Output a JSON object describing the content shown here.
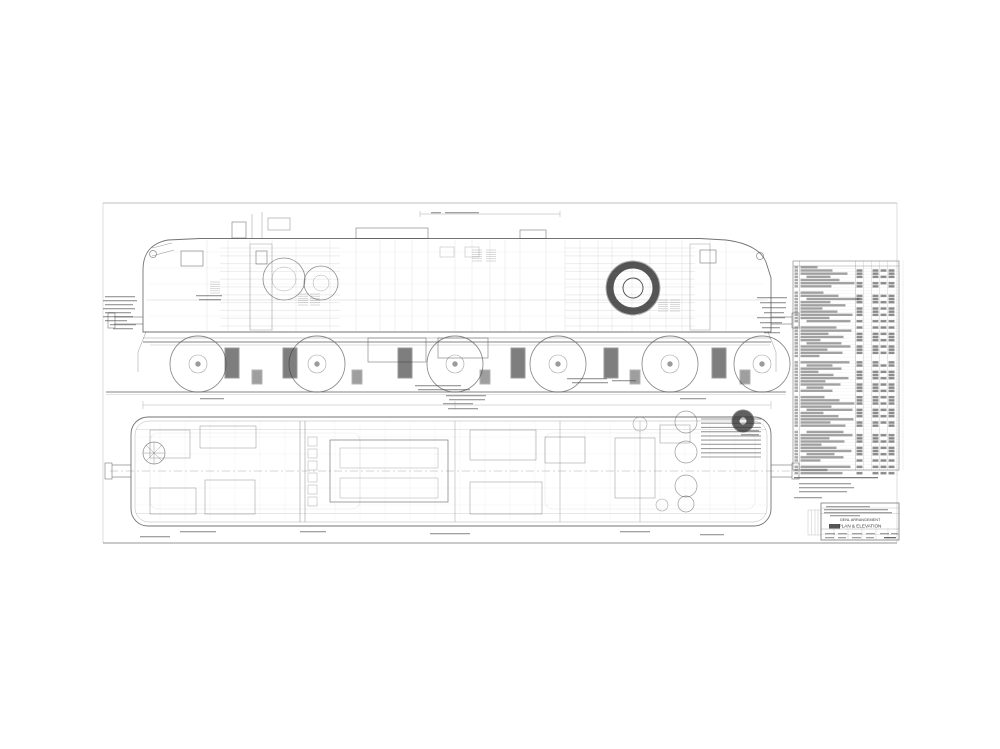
{
  "title_block": {
    "arrangement_label": "GENL ARRANGEMENT",
    "view_label": "PLAN & ELEVATION"
  },
  "figure": {
    "ink": "#5a5a5a",
    "dark": "#2a2a2a",
    "faint": "#9a9a9a",
    "elevation": {
      "wheel_xs": [
        198,
        317,
        455,
        558,
        670,
        762
      ],
      "wheel_cy": 364,
      "wheel_r": 28,
      "hub_r": 9,
      "journals": [
        [
          225,
          348
        ],
        [
          283,
          348
        ],
        [
          398,
          348
        ],
        [
          511,
          348
        ],
        [
          604,
          348
        ],
        [
          712,
          348
        ]
      ],
      "spring_blobs": [
        [
          252,
          370
        ],
        [
          352,
          370
        ],
        [
          480,
          370
        ],
        [
          630,
          370
        ],
        [
          740,
          370
        ]
      ],
      "panel_xs": [
        207,
        228,
        250,
        272,
        296,
        330,
        356,
        380,
        395,
        412,
        428,
        455,
        472,
        490,
        505,
        520,
        546,
        565,
        580,
        598,
        612,
        632,
        650,
        666,
        682,
        710,
        726
      ],
      "hline_ys": [
        252,
        268,
        284,
        300,
        316
      ],
      "louvers": [
        [
          298,
          294
        ],
        [
          310,
          294
        ],
        [
          472,
          250
        ],
        [
          486,
          250
        ],
        [
          658,
          300
        ],
        [
          670,
          300
        ],
        [
          210,
          282
        ]
      ]
    },
    "plan": {
      "vline_xs": [
        160,
        185,
        210,
        235,
        260,
        285,
        335,
        360,
        385,
        410,
        435,
        460,
        485,
        510,
        535,
        585,
        610,
        635,
        660,
        685,
        710,
        735
      ],
      "hline_ys": [
        437,
        454,
        488,
        505
      ],
      "cyl_col": {
        "x": 308,
        "y0": 437,
        "step": 12,
        "n": 6,
        "s": 9
      },
      "circle_stack": {
        "cx": 686,
        "cys": [
          422,
          452,
          486,
          504
        ],
        "rs": [
          11,
          11,
          11,
          8
        ]
      }
    },
    "parts_list": {
      "x": 793,
      "y": 261,
      "w": 106,
      "h": 209,
      "rows": 66,
      "col_xs": [
        856,
        864,
        872,
        880,
        888
      ]
    },
    "strips": [
      [
        431,
        212,
        10
      ],
      [
        445,
        212,
        34
      ],
      [
        105,
        296,
        30
      ],
      [
        103,
        300,
        34
      ],
      [
        105,
        304,
        28
      ],
      [
        103,
        308,
        32
      ],
      [
        105,
        312,
        26
      ],
      [
        103,
        316,
        30
      ],
      [
        105,
        320,
        22
      ],
      [
        110,
        324,
        26
      ],
      [
        113,
        328,
        20
      ],
      [
        196,
        295,
        26
      ],
      [
        199,
        299,
        22
      ],
      [
        415,
        385,
        46
      ],
      [
        418,
        389,
        52
      ],
      [
        446,
        395,
        40
      ],
      [
        449,
        399,
        36
      ],
      [
        567,
        378,
        40
      ],
      [
        572,
        382,
        36
      ],
      [
        612,
        380,
        24
      ],
      [
        443,
        403,
        30
      ],
      [
        200,
        398,
        24
      ],
      [
        680,
        398,
        26
      ],
      [
        448,
        408,
        30
      ],
      [
        737,
        430,
        22
      ],
      [
        741,
        434,
        18
      ],
      [
        757,
        297,
        30
      ],
      [
        760,
        302,
        26
      ],
      [
        762,
        307,
        24
      ],
      [
        764,
        312,
        20
      ],
      [
        757,
        317,
        28
      ],
      [
        760,
        322,
        22
      ],
      [
        762,
        327,
        18
      ],
      [
        764,
        332,
        16
      ],
      [
        180,
        531,
        36
      ],
      [
        300,
        531,
        26
      ],
      [
        430,
        533,
        40
      ],
      [
        620,
        531,
        30
      ],
      [
        700,
        534,
        24
      ],
      [
        140,
        536,
        30
      ],
      [
        794,
        477,
        84,
        0.7
      ],
      [
        799,
        483,
        52
      ],
      [
        799,
        487,
        55
      ],
      [
        799,
        491,
        48
      ],
      [
        794,
        497,
        28
      ],
      [
        826,
        506,
        44
      ],
      [
        824,
        509,
        64
      ],
      [
        824,
        512,
        68
      ],
      [
        830,
        515,
        30
      ],
      [
        825,
        533,
        10
      ],
      [
        838,
        533,
        9
      ],
      [
        852,
        533,
        10
      ],
      [
        866,
        533,
        9
      ],
      [
        880,
        533,
        9
      ],
      [
        891,
        533,
        7
      ],
      [
        825,
        537,
        9
      ],
      [
        838,
        537,
        8
      ],
      [
        852,
        537,
        9
      ],
      [
        866,
        537,
        8
      ],
      [
        884,
        537,
        12,
        0.8
      ]
    ],
    "hatches": [
      [
        701,
        419,
        60,
        38,
        9,
        0.45
      ],
      [
        220,
        248,
        120,
        78,
        10,
        0.07
      ],
      [
        565,
        248,
        130,
        78,
        10,
        0.07
      ]
    ]
  }
}
